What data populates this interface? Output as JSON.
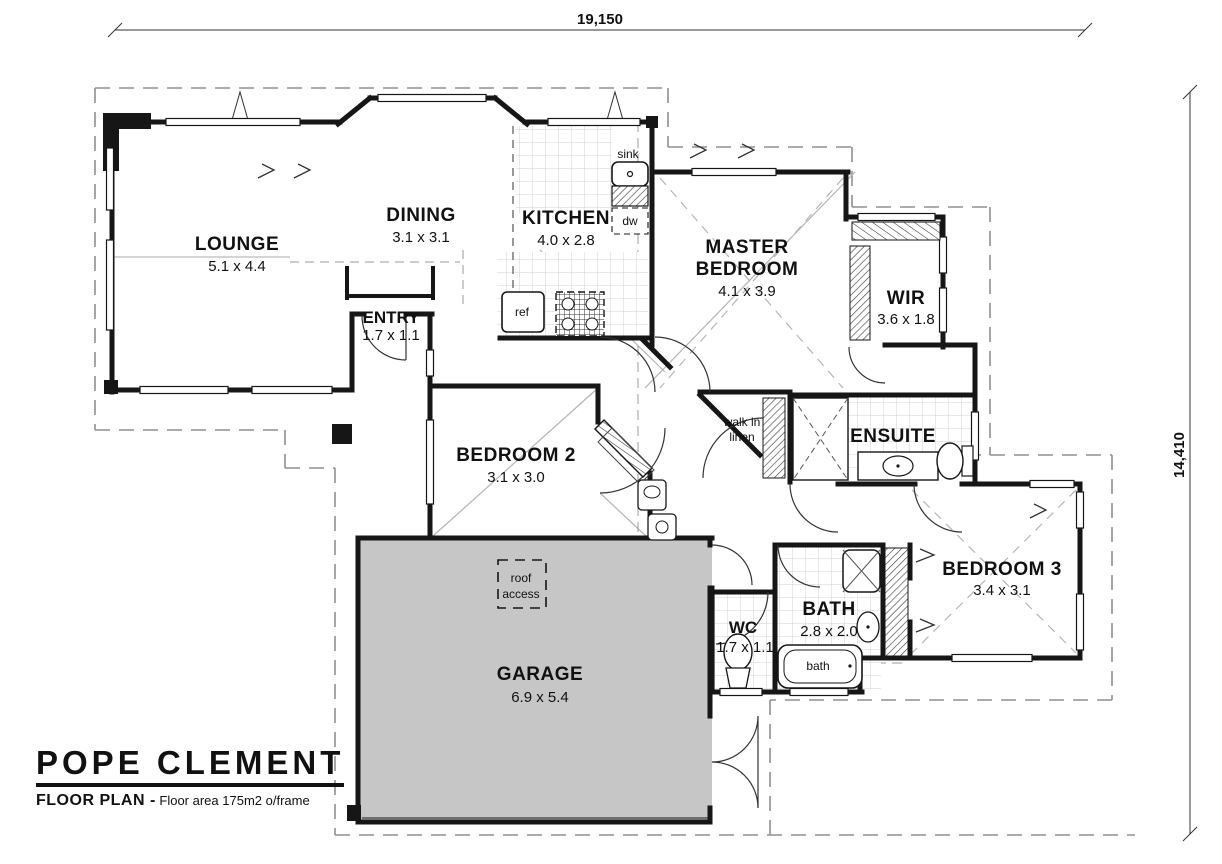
{
  "drawing": {
    "title": "POPE CLEMENT",
    "subtitle": "FLOOR PLAN -",
    "subtitle_note": "Floor area 175m2 o/frame"
  },
  "dimensions": {
    "overall_width": "19,150",
    "overall_height": "14,410"
  },
  "rooms": {
    "lounge": {
      "name": "LOUNGE",
      "size": "5.1 x 4.4"
    },
    "dining": {
      "name": "DINING",
      "size": "3.1 x 3.1"
    },
    "kitchen": {
      "name": "KITCHEN",
      "size": "4.0 x 2.8"
    },
    "entry": {
      "name": "ENTRY",
      "size": "1.7 x 1.1"
    },
    "master_bedroom": {
      "name_line1": "MASTER",
      "name_line2": "BEDROOM",
      "size": "4.1 x 3.9"
    },
    "wir": {
      "name": "WIR",
      "size": "3.6 x 1.8"
    },
    "bedroom2": {
      "name": "BEDROOM 2",
      "size": "3.1 x 3.0"
    },
    "walk_in_linen": {
      "name_line1": "walk in",
      "name_line2": "linen"
    },
    "ensuite": {
      "name": "ENSUITE"
    },
    "bedroom3": {
      "name": "BEDROOM 3",
      "size": "3.4 x 3.1"
    },
    "garage": {
      "name": "GARAGE",
      "size": "6.9 x 5.4"
    },
    "wc": {
      "name": "WC",
      "size": "1.7 x 1.1"
    },
    "bath": {
      "name": "BATH",
      "size": "2.8 x 2.0"
    }
  },
  "fixtures": {
    "sink": "sink",
    "dishwasher": "dw",
    "refrigerator": "ref",
    "bathtub": "bath",
    "roof_access_line1": "roof",
    "roof_access_line2": "access"
  },
  "colors": {
    "wall": "#161616",
    "garage_fill": "#c6c6c6",
    "roofline": "#8f8f8f",
    "tile_line": "#d2d2d2"
  }
}
